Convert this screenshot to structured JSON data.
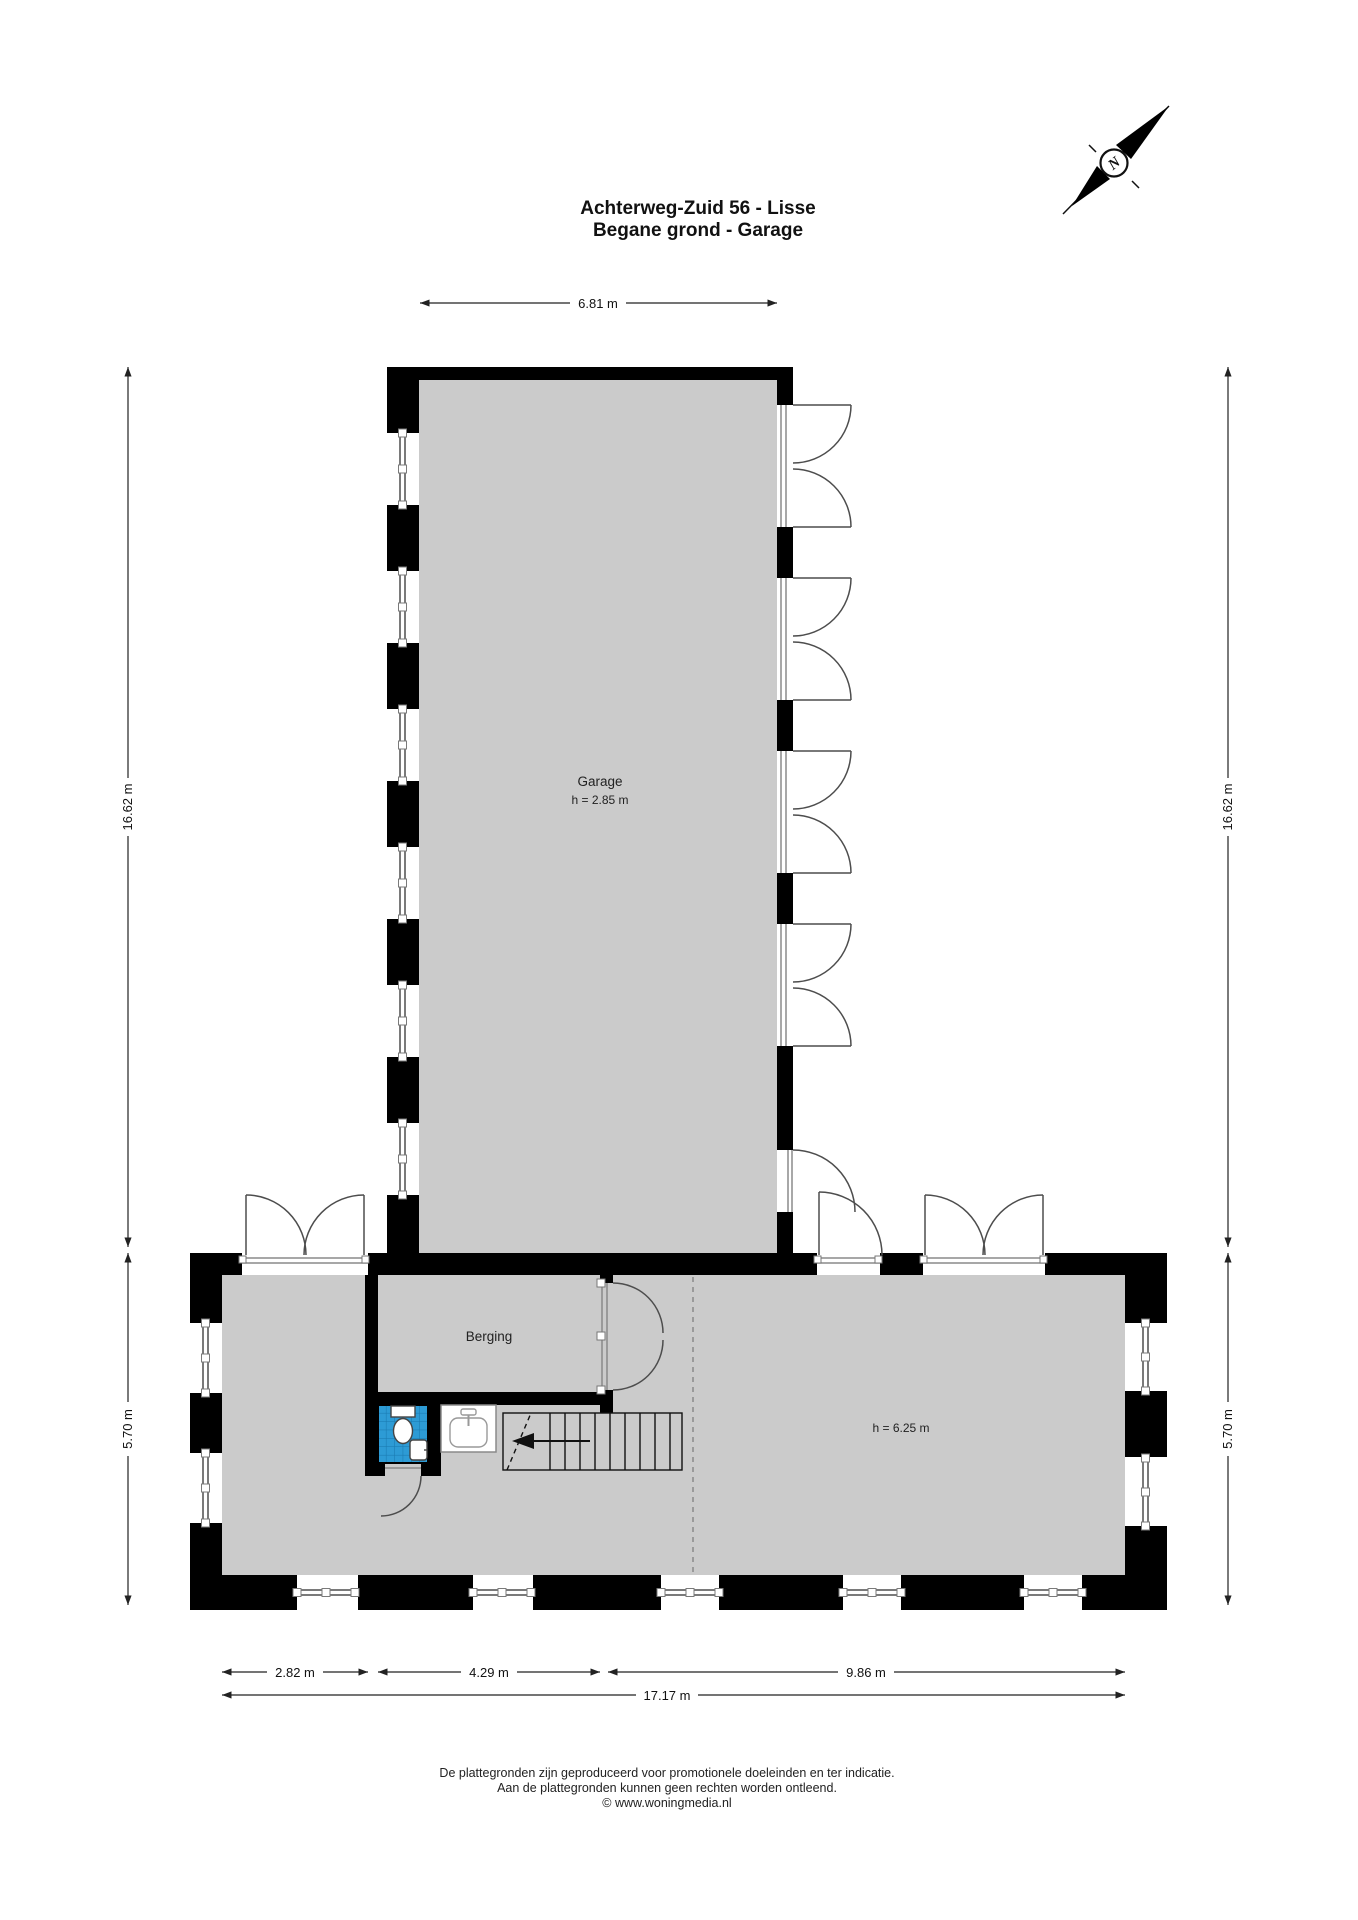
{
  "title": {
    "line1": "Achterweg-Zuid 56 - Lisse",
    "line2": "Begane grond - Garage"
  },
  "compass": {
    "label": "N"
  },
  "rooms": {
    "garage": {
      "name": "Garage",
      "height": "h = 2.85 m"
    },
    "berging": {
      "name": "Berging"
    },
    "main_hall": {
      "height": "h = 6.25 m"
    }
  },
  "dimensions": {
    "top_width": "6.81 m",
    "left_upper": "16.62 m",
    "left_lower": "5.70 m",
    "right_upper": "16.62 m",
    "right_lower": "5.70 m",
    "bottom_left": "2.82 m",
    "bottom_middle": "4.29 m",
    "bottom_right": "9.86 m",
    "bottom_total": "17.17 m"
  },
  "footer": {
    "line1": "De plattegronden zijn geproduceerd voor promotionele doeleinden en ter indicatie.",
    "line2": "Aan de plattegronden kunnen geen rechten worden ontleend.",
    "line3": "© www.woningmedia.nl"
  },
  "colors": {
    "wall": "#000000",
    "floor": "#cbcbcb",
    "window": "#7a7a7a",
    "tile_blue": "#2d9bd5",
    "tile_grid": "#1877ad",
    "door_arc": "#4d4d4d"
  }
}
